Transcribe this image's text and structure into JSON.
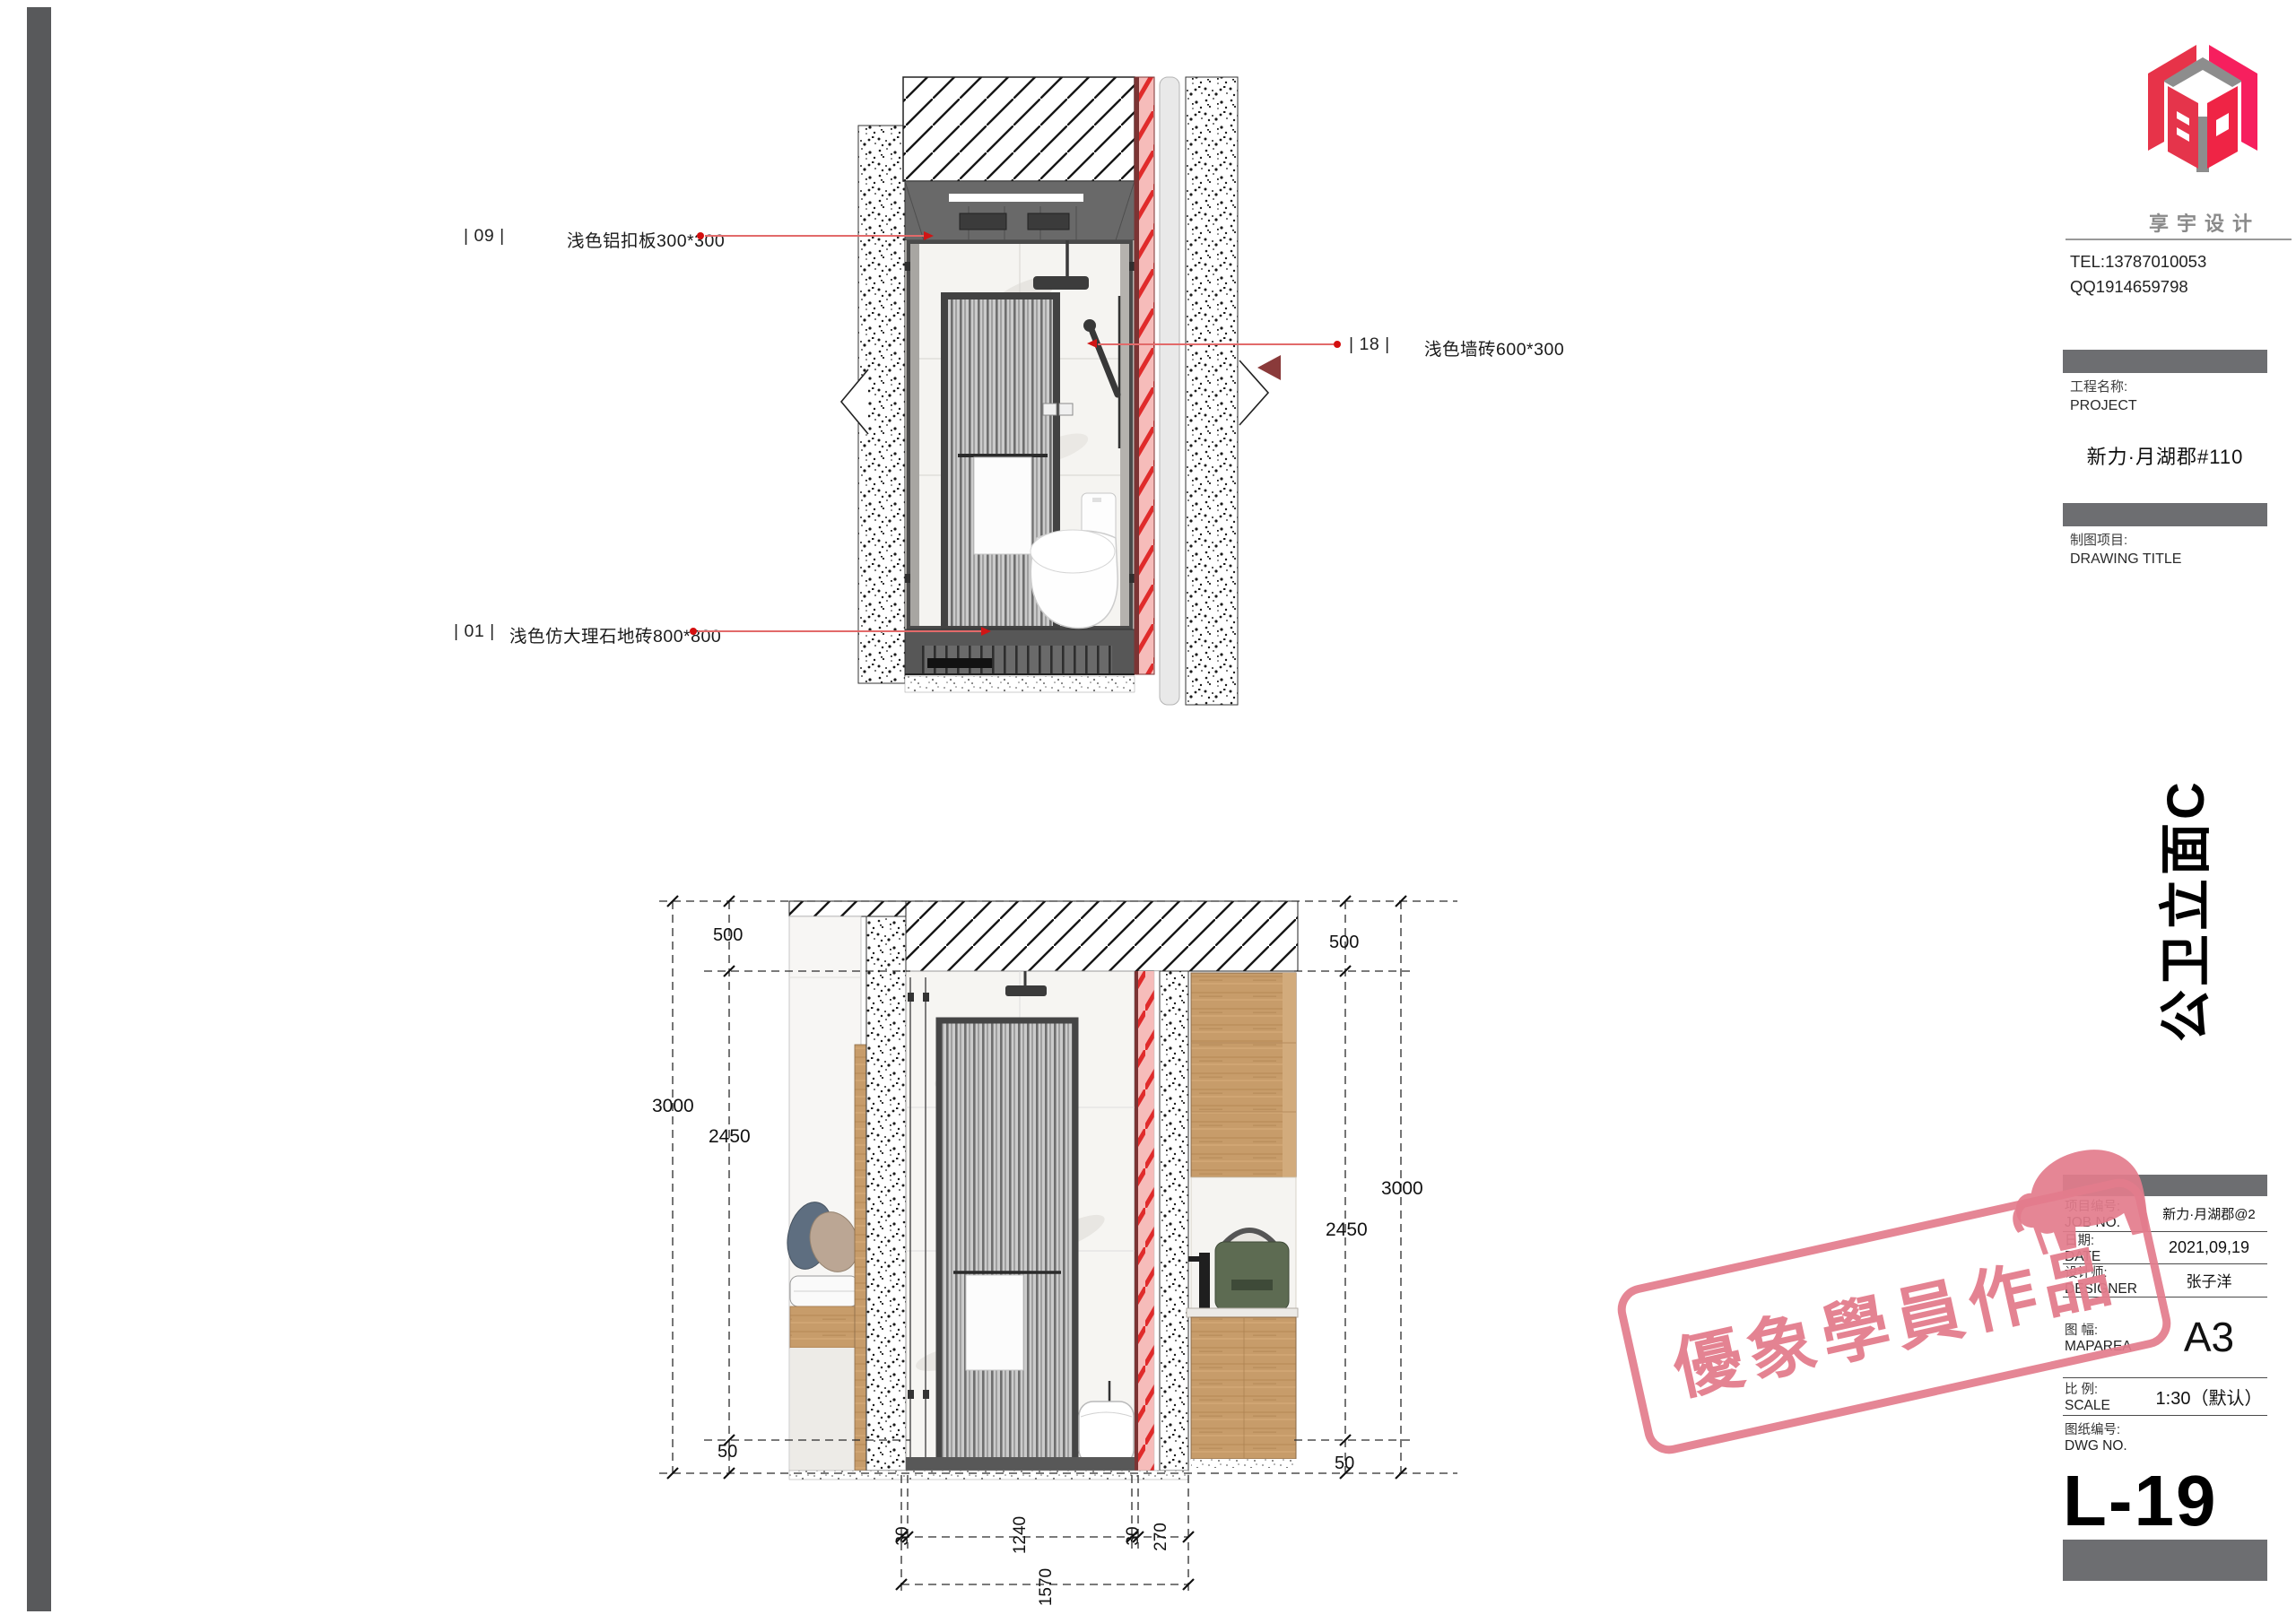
{
  "drawing": {
    "upper_annotations": {
      "a09": {
        "tag": "| 09 |",
        "text": "浅色铝扣板300*300"
      },
      "a18": {
        "tag": "| 18 |",
        "text": "浅色墙砖600*300"
      },
      "a01": {
        "tag": "| 01 |",
        "text": "浅色仿大理石地砖800*800"
      }
    },
    "dims": {
      "left": {
        "top": "500",
        "overall": "3000",
        "mid": "2450",
        "bottom": "50"
      },
      "right": {
        "top": "500",
        "overall": "3000",
        "mid": "2450",
        "bottom": "50"
      },
      "bottom": {
        "d1": "30",
        "d2": "1240",
        "d3": "30",
        "d4": "270",
        "overall": "1570"
      }
    }
  },
  "titleblock": {
    "brand_name": "享宇设计",
    "tel": "TEL:13787010053",
    "qq": "QQ1914659798",
    "project_label_cn": "工程名称:",
    "project_label_en": "PROJECT",
    "project_name": "新力·月湖郡#110",
    "drawing_label_cn": "制图项目:",
    "drawing_label_en": "DRAWING TITLE",
    "drawing_title": "公卫立面C",
    "rows": [
      {
        "cn": "项目编号:",
        "en": "JOB NO.",
        "value": "新力·月湖郡@2"
      },
      {
        "cn": "日期:",
        "en": "DATE",
        "value": "2021,09,19"
      },
      {
        "cn": "设计师:",
        "en": "DESIGNER",
        "value": "张子洋"
      },
      {
        "cn": "图 幅:",
        "en": "MAPAREA",
        "value": "A3"
      },
      {
        "cn": "比 例:",
        "en": "SCALE",
        "value": "1:30（默认）"
      },
      {
        "cn": "图纸编号:",
        "en": "DWG NO.",
        "value": ""
      }
    ],
    "dwg_no": "L-19"
  },
  "watermark": {
    "text": "優象學員作品"
  }
}
